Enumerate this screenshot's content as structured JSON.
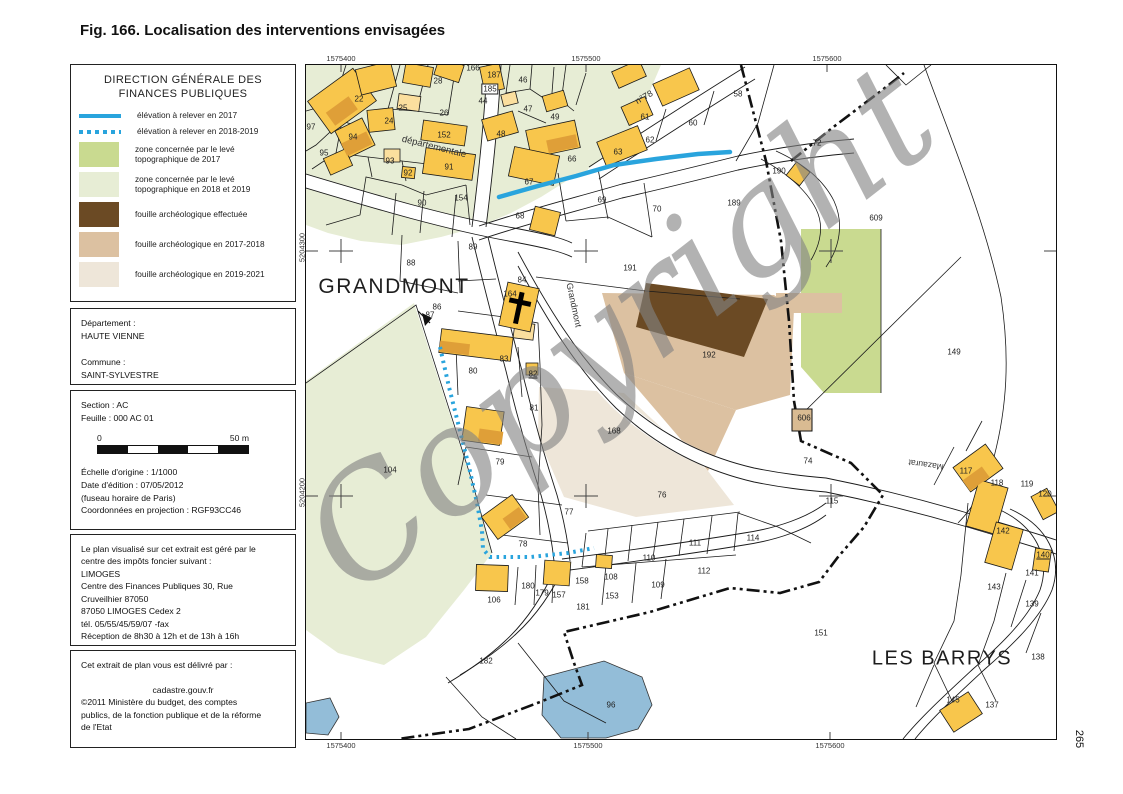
{
  "page": {
    "caption": "Fig. 166. Localisation des interventions envisagées",
    "page_number": "265"
  },
  "panel": {
    "title_line1": "DIRECTION GÉNÉRALE DES",
    "title_line2": "FINANCES PUBLIQUES",
    "legend": [
      {
        "type": "line-solid",
        "color": "#29a4dd",
        "label": "élévation à relever en 2017"
      },
      {
        "type": "line-dotted",
        "color": "#29a4dd",
        "label": "élévation à relever en 2018-2019"
      },
      {
        "type": "swatch",
        "color": "#c9da90",
        "label": "zone concernée par le levé topographique de 2017"
      },
      {
        "type": "swatch",
        "color": "#e7edd5",
        "label": "zone concernée par le levé topographique en 2018 et 2019"
      },
      {
        "type": "swatch",
        "color": "#6b4a24",
        "label": "fouille archéologique effectuée"
      },
      {
        "type": "swatch",
        "color": "#dcc1a1",
        "label": "fouille archéologique en 2017-2018"
      },
      {
        "type": "swatch",
        "color": "#eee6d9",
        "label": "fouille archéologique en 2019-2021"
      }
    ],
    "identity_lines": [
      "Département :",
      "HAUTE VIENNE",
      "",
      "Commune :",
      "SAINT-SYLVESTRE"
    ],
    "section_lines": [
      "Section : AC",
      "Feuille : 000 AC 01"
    ],
    "scale": {
      "start": "0",
      "end": "50 m"
    },
    "edition_lines": [
      "Échelle d'origine : 1/1000",
      "Date d'édition : 07/05/2012",
      "(fuseau horaire de Paris)",
      "Coordonnées en projection : RGF93CC46"
    ],
    "gestion_lines": [
      "Le plan visualisé sur cet extrait est géré par le",
      "centre des impôts foncier suivant :",
      "LIMOGES",
      "Centre des Finances Publiques 30, Rue",
      "Cruveilhier 87050",
      "87050 LIMOGES    Cedex 2",
      "tél. 05/55/45/59/07 -fax",
      "Réception de 8h30 à 12h et de 13h à 16h"
    ],
    "delivery": {
      "intro": "Cet extrait de plan vous est délivré par :",
      "site": "cadastre.gouv.fr",
      "copyright_lines": [
        "©2011 Ministère du budget, des comptes",
        "publics, de la fonction publique et de la réforme",
        "de l'Etat"
      ]
    }
  },
  "map": {
    "watermark": "Copyright",
    "place_labels": [
      {
        "text": "GRANDMONT",
        "x": 88,
        "y": 222,
        "size": 21
      },
      {
        "text": "LES BARRYS",
        "x": 636,
        "y": 594,
        "size": 20
      }
    ],
    "road_labels": [
      {
        "text": "départementale",
        "x": 128,
        "y": 82,
        "rot": 14,
        "size": 9.5
      },
      {
        "text": "n°78",
        "x": 338,
        "y": 32,
        "rot": -30,
        "size": 9
      },
      {
        "text": "Grandmont",
        "x": 268,
        "y": 240,
        "rot": 78,
        "size": 9
      },
      {
        "text": "Mazaurat",
        "x": 620,
        "y": 400,
        "rot": 188,
        "size": 8.5
      }
    ],
    "coordinates": {
      "top": [
        {
          "t": "1575400",
          "x": 35
        },
        {
          "t": "1575500",
          "x": 280
        },
        {
          "t": "1575600",
          "x": 521
        }
      ],
      "bottom": [
        {
          "t": "1575400",
          "x": 35
        },
        {
          "t": "1575500",
          "x": 282
        },
        {
          "t": "1575600",
          "x": 524
        }
      ],
      "left": [
        {
          "t": "5204300",
          "y": 186
        },
        {
          "t": "5204200",
          "y": 431
        }
      ]
    },
    "parcels": [
      {
        "n": "97",
        "x": 5,
        "y": 62
      },
      {
        "n": "28",
        "x": 132,
        "y": 16
      },
      {
        "n": "22",
        "x": 53,
        "y": 34
      },
      {
        "n": "25",
        "x": 97,
        "y": 43
      },
      {
        "n": "24",
        "x": 83,
        "y": 56
      },
      {
        "n": "26",
        "x": 138,
        "y": 48
      },
      {
        "n": "152",
        "x": 138,
        "y": 70
      },
      {
        "n": "94",
        "x": 47,
        "y": 72
      },
      {
        "n": "95",
        "x": 18,
        "y": 88
      },
      {
        "n": "93",
        "x": 84,
        "y": 96
      },
      {
        "n": "92",
        "x": 102,
        "y": 108
      },
      {
        "n": "91",
        "x": 143,
        "y": 102
      },
      {
        "n": "90",
        "x": 116,
        "y": 138
      },
      {
        "n": "154",
        "x": 155,
        "y": 133
      },
      {
        "n": "88",
        "x": 105,
        "y": 198
      },
      {
        "n": "89",
        "x": 167,
        "y": 182
      },
      {
        "n": "166",
        "x": 167,
        "y": 3
      },
      {
        "n": "187",
        "x": 188,
        "y": 10
      },
      {
        "n": "185",
        "x": 184,
        "y": 24,
        "box": 1
      },
      {
        "n": "44",
        "x": 177,
        "y": 36
      },
      {
        "n": "46",
        "x": 217,
        "y": 15
      },
      {
        "n": "47",
        "x": 222,
        "y": 44
      },
      {
        "n": "48",
        "x": 195,
        "y": 69
      },
      {
        "n": "49",
        "x": 249,
        "y": 52
      },
      {
        "n": "58",
        "x": 432,
        "y": 29
      },
      {
        "n": "61",
        "x": 339,
        "y": 52
      },
      {
        "n": "60",
        "x": 387,
        "y": 58
      },
      {
        "n": "62",
        "x": 344,
        "y": 75
      },
      {
        "n": "63",
        "x": 312,
        "y": 87
      },
      {
        "n": "66",
        "x": 266,
        "y": 94
      },
      {
        "n": "67",
        "x": 223,
        "y": 117
      },
      {
        "n": "68",
        "x": 214,
        "y": 151
      },
      {
        "n": "69",
        "x": 296,
        "y": 135
      },
      {
        "n": "70",
        "x": 351,
        "y": 144
      },
      {
        "n": "72",
        "x": 511,
        "y": 78
      },
      {
        "n": "190",
        "x": 473,
        "y": 106
      },
      {
        "n": "189",
        "x": 428,
        "y": 138
      },
      {
        "n": "191",
        "x": 324,
        "y": 203
      },
      {
        "n": "609",
        "x": 570,
        "y": 153
      },
      {
        "n": "149",
        "x": 648,
        "y": 287
      },
      {
        "n": "86",
        "x": 131,
        "y": 242
      },
      {
        "n": "87",
        "x": 124,
        "y": 250
      },
      {
        "n": "84",
        "x": 216,
        "y": 215
      },
      {
        "n": "164",
        "x": 204,
        "y": 229
      },
      {
        "n": "83",
        "x": 198,
        "y": 294
      },
      {
        "n": "80",
        "x": 167,
        "y": 306
      },
      {
        "n": "82",
        "x": 227,
        "y": 309,
        "u": 1
      },
      {
        "n": "81",
        "x": 228,
        "y": 343
      },
      {
        "n": "79",
        "x": 194,
        "y": 397
      },
      {
        "n": "168",
        "x": 308,
        "y": 366
      },
      {
        "n": "192",
        "x": 403,
        "y": 290
      },
      {
        "n": "606",
        "x": 498,
        "y": 353
      },
      {
        "n": "74",
        "x": 502,
        "y": 396
      },
      {
        "n": "115",
        "x": 526,
        "y": 436
      },
      {
        "n": "76",
        "x": 356,
        "y": 430
      },
      {
        "n": "77",
        "x": 263,
        "y": 447
      },
      {
        "n": "78",
        "x": 217,
        "y": 479
      },
      {
        "n": "104",
        "x": 84,
        "y": 405
      },
      {
        "n": "111",
        "x": 389,
        "y": 478
      },
      {
        "n": "110",
        "x": 343,
        "y": 493
      },
      {
        "n": "112",
        "x": 398,
        "y": 506
      },
      {
        "n": "108",
        "x": 305,
        "y": 512
      },
      {
        "n": "158",
        "x": 276,
        "y": 516
      },
      {
        "n": "109",
        "x": 352,
        "y": 520
      },
      {
        "n": "180",
        "x": 222,
        "y": 521
      },
      {
        "n": "179",
        "x": 236,
        "y": 528
      },
      {
        "n": "157",
        "x": 253,
        "y": 530
      },
      {
        "n": "153",
        "x": 306,
        "y": 531
      },
      {
        "n": "106",
        "x": 188,
        "y": 535
      },
      {
        "n": "181",
        "x": 277,
        "y": 542
      },
      {
        "n": "114",
        "x": 447,
        "y": 473
      },
      {
        "n": "151",
        "x": 515,
        "y": 568
      },
      {
        "n": "182",
        "x": 180,
        "y": 596
      },
      {
        "n": "96",
        "x": 305,
        "y": 640
      },
      {
        "n": "117",
        "x": 660,
        "y": 406
      },
      {
        "n": "118",
        "x": 691,
        "y": 418
      },
      {
        "n": "119",
        "x": 721,
        "y": 419
      },
      {
        "n": "120",
        "x": 739,
        "y": 429
      },
      {
        "n": "142",
        "x": 697,
        "y": 466
      },
      {
        "n": "140",
        "x": 737,
        "y": 490,
        "u": 1
      },
      {
        "n": "141",
        "x": 726,
        "y": 508
      },
      {
        "n": "143",
        "x": 688,
        "y": 522
      },
      {
        "n": "139",
        "x": 726,
        "y": 539
      },
      {
        "n": "138",
        "x": 732,
        "y": 592
      },
      {
        "n": "145",
        "x": 647,
        "y": 635
      },
      {
        "n": "137",
        "x": 686,
        "y": 640
      }
    ]
  }
}
